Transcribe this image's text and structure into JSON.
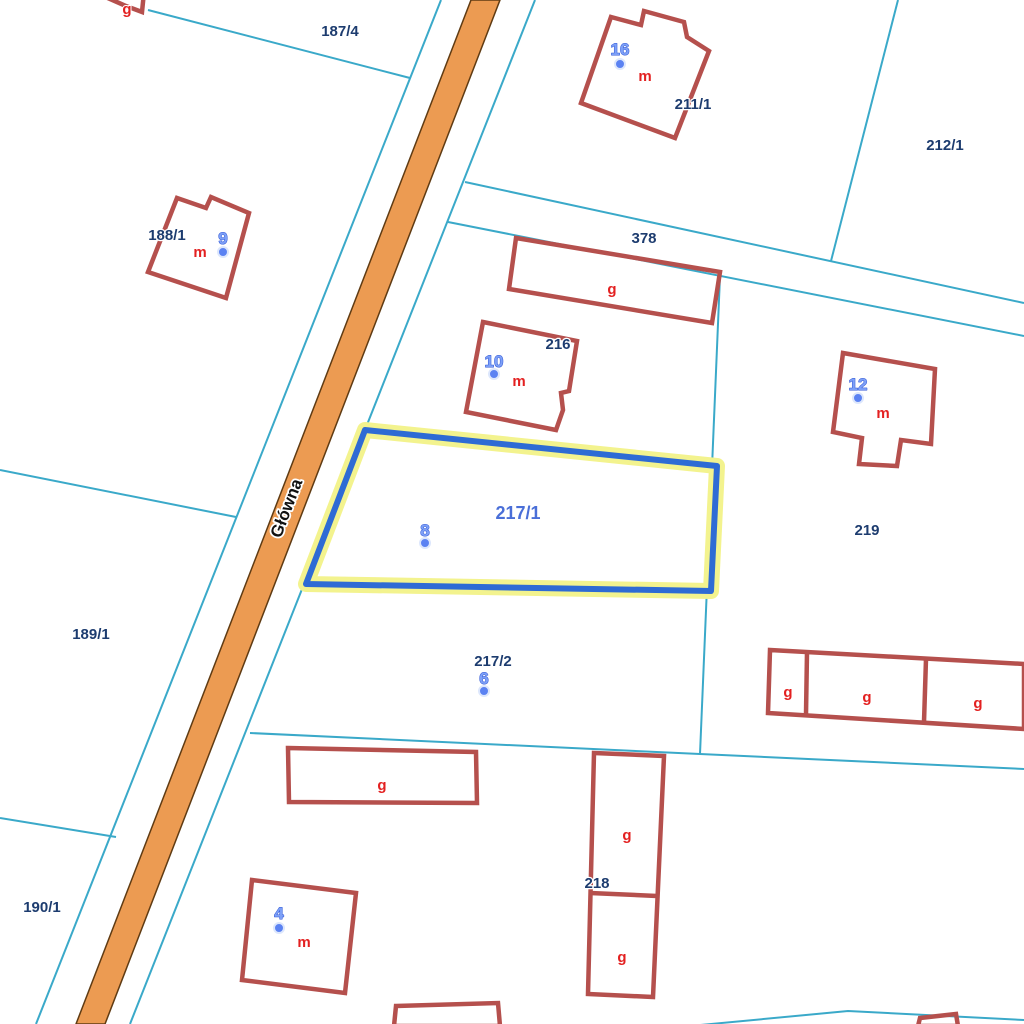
{
  "street": {
    "name": "Główna"
  },
  "selection": {
    "parcel_id": "217/1",
    "address_number": "8"
  },
  "parcels": [
    {
      "id": "187/4"
    },
    {
      "id": "211/1"
    },
    {
      "id": "212/1"
    },
    {
      "id": "188/1"
    },
    {
      "id": "378"
    },
    {
      "id": "216"
    },
    {
      "id": "219"
    },
    {
      "id": "217/1",
      "selected": true
    },
    {
      "id": "189/1"
    },
    {
      "id": "217/2"
    },
    {
      "id": "218"
    },
    {
      "id": "190/1"
    }
  ],
  "addresses": [
    {
      "number": "16"
    },
    {
      "number": "9"
    },
    {
      "number": "10"
    },
    {
      "number": "12"
    },
    {
      "number": "8"
    },
    {
      "number": "6"
    },
    {
      "number": "4"
    }
  ],
  "buildings": {
    "residential_label": "m",
    "outbuilding_label": "g"
  },
  "colors": {
    "road_fill": "#ec9b52",
    "road_edge": "#5f3b13",
    "parcel_line": "#3aa9c9",
    "building_outline": "#b5504d",
    "building_label": "#e32020",
    "parcel_label": "#1d3c6f",
    "selected_parcel_label": "#4a6fd8",
    "address_fill": "#7da0f7",
    "address_stroke": "#3056d5",
    "address_dot": "#5b82f2",
    "selection_stroke": "#2e6bd4",
    "selection_halo": "#f3f38e",
    "street_label": "#111111"
  }
}
